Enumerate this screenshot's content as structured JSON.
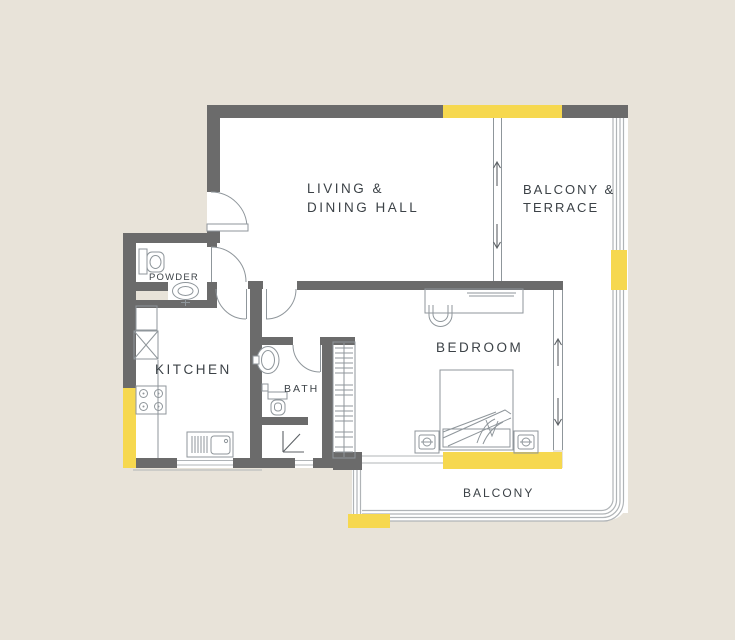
{
  "title": "Apartment floor plan",
  "colors": {
    "background": "#e8e3d9",
    "wall": "#6b6b6b",
    "window": "#f6d84f",
    "floor": "#ffffff",
    "fx": "#8f969b",
    "rail": "#b0b4b7",
    "text": "#3c4247",
    "arrow": "#5d6266"
  },
  "rooms": {
    "living": {
      "line1": "LIVING &",
      "line2": "DINING HALL"
    },
    "terrace": {
      "line1": "BALCONY &",
      "line2": "TERRACE"
    },
    "powder": {
      "label": "POWDER"
    },
    "kitchen": {
      "label": "KITCHEN"
    },
    "bath": {
      "label": "BATH"
    },
    "bedroom": {
      "label": "BEDROOM"
    },
    "balcony": {
      "label": "BALCONY"
    }
  },
  "fixtures": [
    "entry-door",
    "powder-door",
    "kitchen-door",
    "hall-door",
    "bath-door",
    "sliding-door-terrace",
    "sliding-door-balcony",
    "powder-toilet",
    "powder-basin",
    "kitchen-upper-cabinet",
    "kitchen-tall-unit",
    "kitchen-hob",
    "kitchen-sink",
    "bath-basin",
    "bath-toilet",
    "shower-corner",
    "wardrobe",
    "bed",
    "nightstand-left",
    "nightstand-right",
    "desk",
    "desk-chair",
    "window-top",
    "window-kitchen",
    "window-bedroom",
    "window-railing",
    "window-balcony"
  ]
}
